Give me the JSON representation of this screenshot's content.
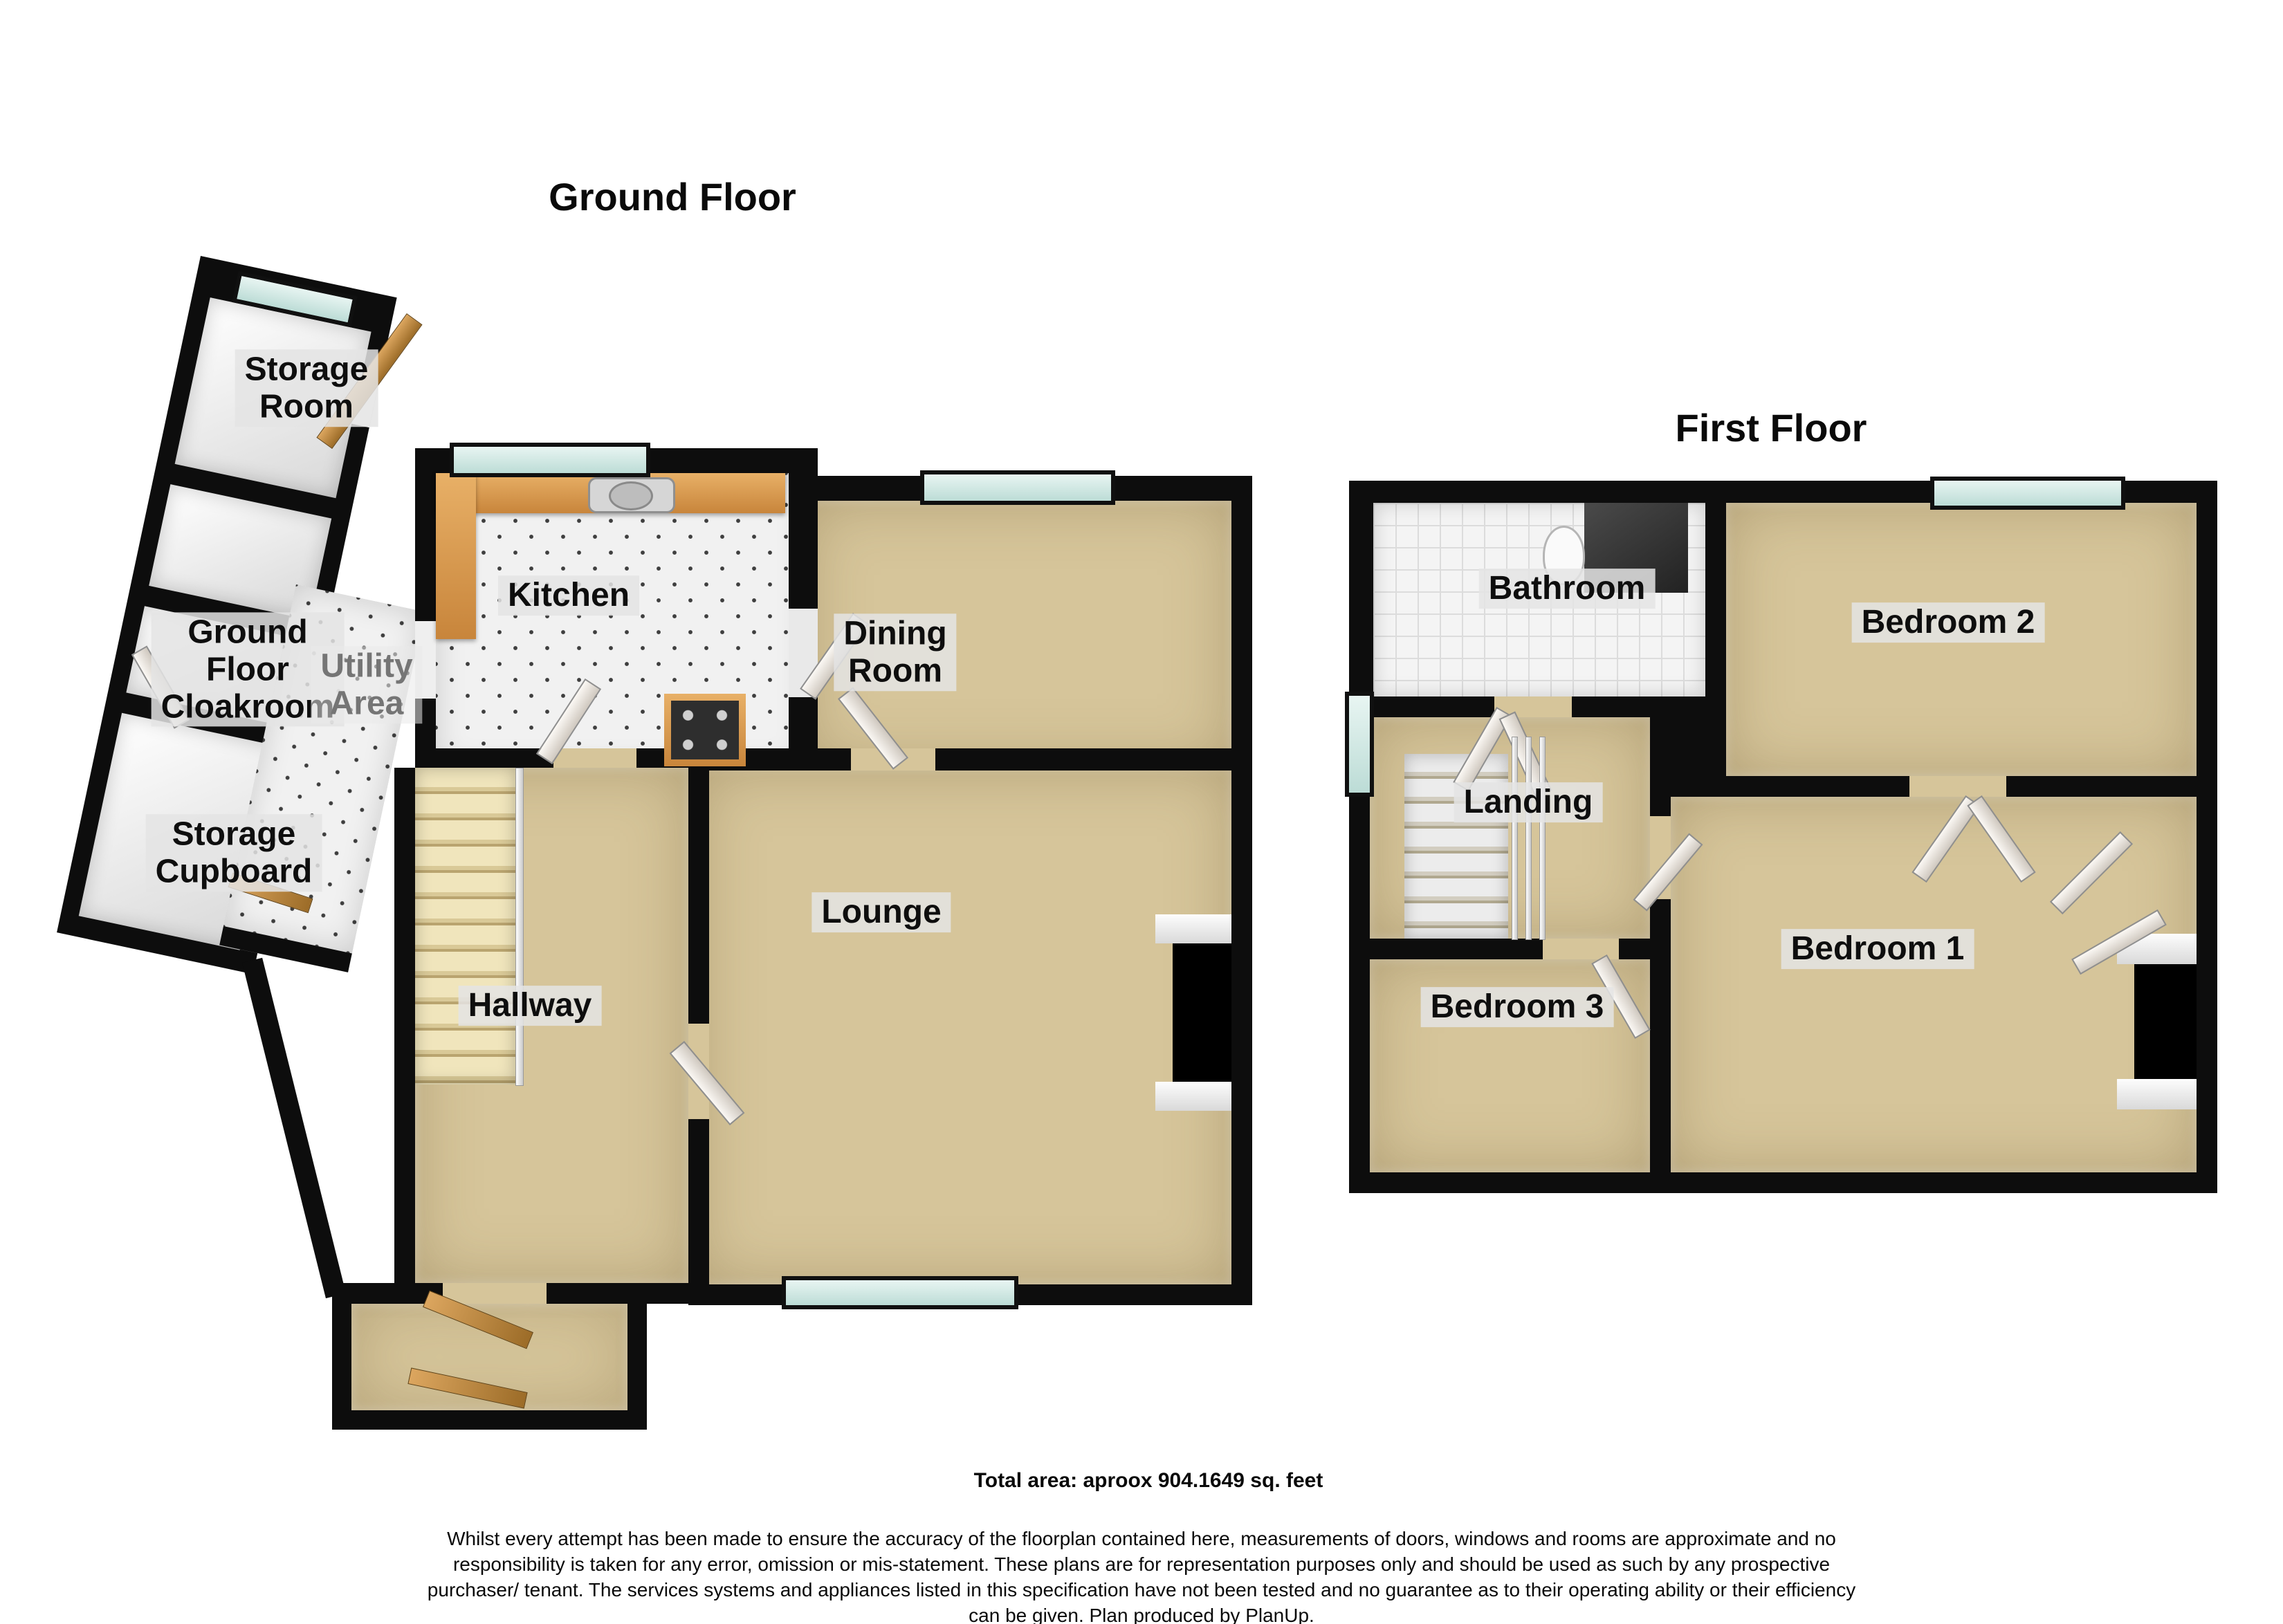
{
  "titles": {
    "ground_floor": "Ground Floor",
    "first_floor": "First Floor"
  },
  "ground_floor_rooms": {
    "storage_room": "Storage\nRoom",
    "cloakroom": "Ground\nFloor\nCloakroom",
    "utility": "Utility\nArea",
    "kitchen": "Kitchen",
    "dining": "Dining\nRoom",
    "lounge": "Lounge",
    "hallway": "Hallway",
    "storage_cupboard": "Storage\nCupboard"
  },
  "first_floor_rooms": {
    "bathroom": "Bathroom",
    "bedroom2": "Bedroom 2",
    "landing": "Landing",
    "bedroom1": "Bedroom 1",
    "bedroom3": "Bedroom 3"
  },
  "footer": {
    "total_area": "Total area: aproox 904.1649 sq. feet",
    "disclaimer": "Whilst every attempt has been made to ensure the accuracy of the floorplan contained here, measurements of doors, windows and rooms are approximate and no responsibility is taken for any error, omission or mis-statement. These plans are for representation purposes only and should be used as such by any prospective purchaser/ tenant. The services systems and appliances listed in this specification have not been tested and no guarantee as to their operating ability or their efficiency can be given. Plan produced by PlanUp."
  },
  "colors": {
    "wall": "#0d0d0d",
    "carpet": "#d6c59a",
    "tile": "#f1f1f1",
    "window": "#bcdcd6",
    "counter": "#e8b067",
    "wood": "#dca65f",
    "stair_light": "#f0e5bc",
    "utility_text": "#757575"
  }
}
